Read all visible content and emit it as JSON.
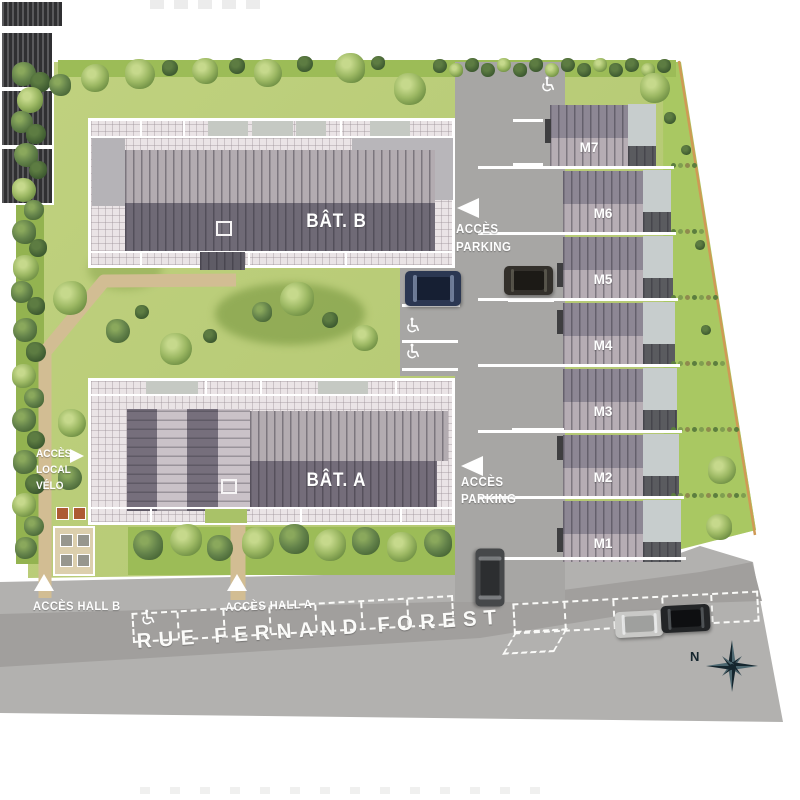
{
  "site": {
    "buildings": {
      "b": "BÂT. B",
      "a": "BÂT. A"
    },
    "maisons": [
      "M7",
      "M6",
      "M5",
      "M4",
      "M3",
      "M2",
      "M1"
    ],
    "access": {
      "parking_upper": {
        "line1": "ACCÈS",
        "line2": "PARKING"
      },
      "parking_lower": {
        "line1": "ACCÈS",
        "line2": "PARKING"
      },
      "local_velo": {
        "line1": "ACCÈS",
        "line2": "LOCAL",
        "line3": "VÉLO"
      },
      "hall_b": "ACCÈS HALL B",
      "hall_a": "ACCÈS HALL A"
    },
    "street": "RUE FERNAND FOREST",
    "compass_north": "N",
    "icons": {
      "accessible_parking": "wheelchair-icon",
      "compass": "compass-rose-icon"
    },
    "palette": {
      "lawn": "#b7cb72",
      "orchard_green": "#a9c862",
      "asphalt": "#a7a6a4",
      "road": "#b0afad",
      "roof_light": "#b6adb4",
      "roof_dark": "#6f6a76",
      "carport": "#47474a",
      "path": "#d2bd93",
      "boundary": "#cf9a55",
      "white": "#ffffff"
    }
  }
}
